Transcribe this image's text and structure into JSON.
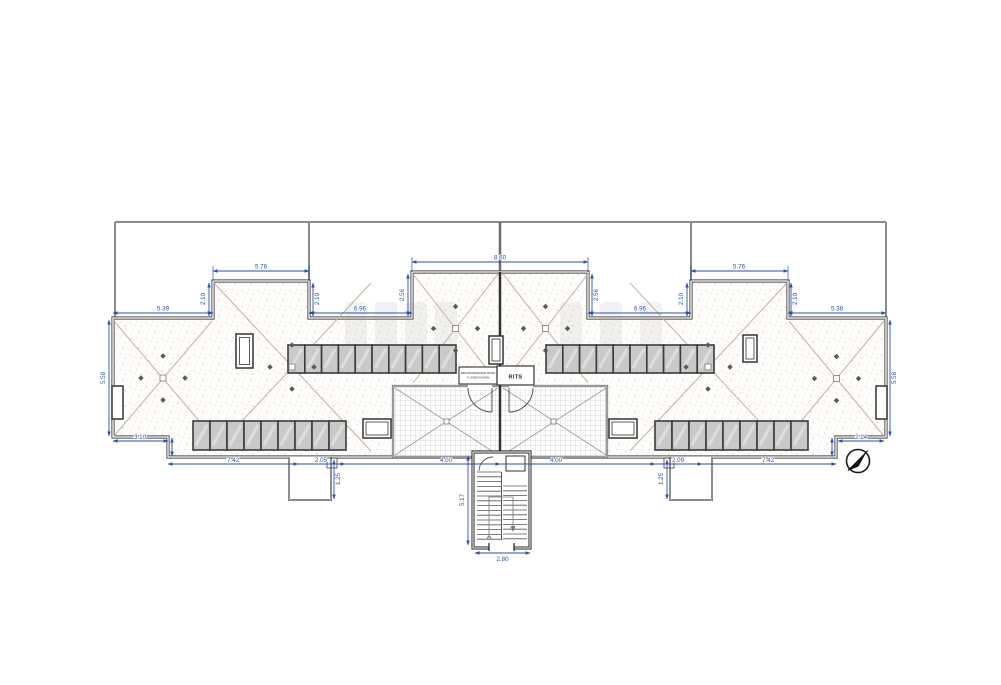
{
  "drawing": {
    "type": "architectural roof plan",
    "labels": {
      "rits": "RITS",
      "note_line1": "BRANDWERENDE WAND",
      "note_line2": "TUSSEN DAKEN"
    },
    "dims": {
      "top_left_span": "5.39",
      "left_block_width": "5.76",
      "left_inner_span": "6.96",
      "center_block_width": "8.60",
      "right_inner_span": "6.96",
      "right_block_width": "5.76",
      "top_right_span": "5.38",
      "left_block_depth": "2.10",
      "center_block_depth": "2.56",
      "right_block_depth": "2.10",
      "left_wing_height": "5.58",
      "right_wing_height": "5.58",
      "left_jog": "3.10",
      "right_jog": "2.14",
      "bottom_1": "7.42",
      "bottom_2": "2.05",
      "bottom_3": "4.00",
      "bottom_4": "4.00",
      "bottom_5": "2.09",
      "bottom_6": "7.42",
      "stair_height": "5.17",
      "stair_width": "2.80",
      "left_box_depth": "1.25",
      "right_box_depth": "1.25"
    },
    "colors": {
      "dimension": "#2b4fad",
      "wall": "#4a4a4a",
      "boundary": "#8a8a8a",
      "panel_fill": "#c9c9c9",
      "panel_frame": "#3b3b3b",
      "hip_line": "#bdb5a3"
    },
    "solar_panel_rows": [
      {
        "x": 288,
        "y": 345,
        "count": 10,
        "panel_w": 16.8,
        "panel_h": 28
      },
      {
        "x": 546,
        "y": 345,
        "count": 10,
        "panel_w": 16.8,
        "panel_h": 28
      },
      {
        "x": 193,
        "y": 421,
        "count": 9,
        "panel_w": 17,
        "panel_h": 29
      },
      {
        "x": 655,
        "y": 421,
        "count": 9,
        "panel_w": 17,
        "panel_h": 29
      }
    ],
    "roof_node_markers": [
      [
        163,
        378
      ],
      [
        292,
        367
      ],
      [
        455.5,
        328.5
      ],
      [
        545.5,
        328.5
      ],
      [
        708,
        367
      ],
      [
        836.5,
        378.5
      ]
    ],
    "terrace_markers": [
      [
        446.5,
        421.5
      ],
      [
        553.5,
        421.5
      ]
    ],
    "north_arrow": "compass pointing north-east"
  }
}
